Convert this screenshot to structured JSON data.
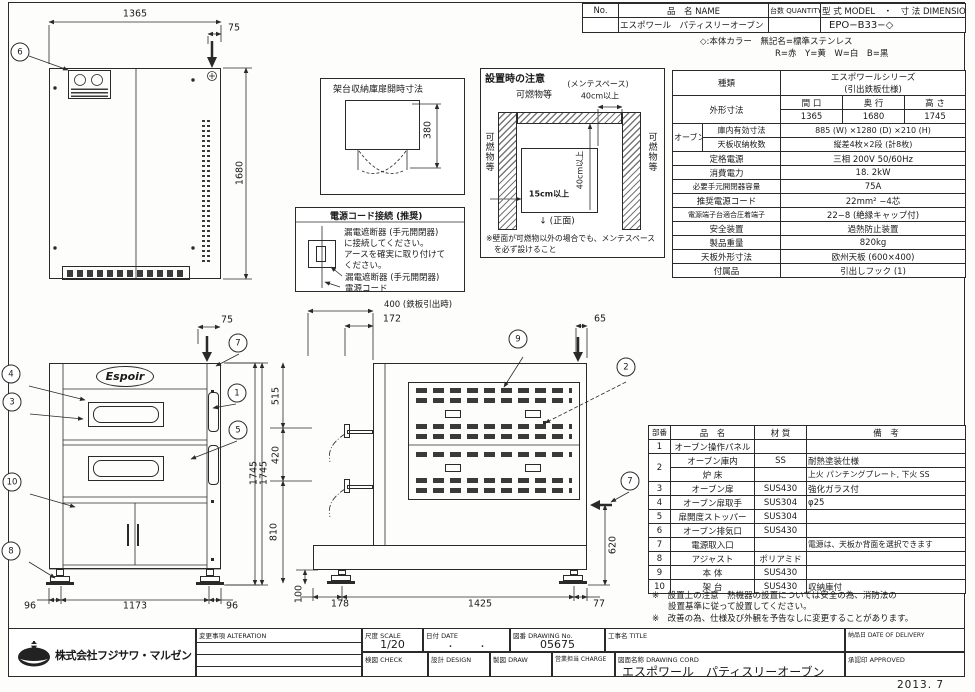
{
  "header_table": {
    "no_label": "No.",
    "name_label": "品　名 NAME",
    "qty_label": "台数 QUANTITY",
    "model_label": "型 式 MODEL　・　寸 法 DIMENSION",
    "name_value": "エスポワール　パティスリーオーブン",
    "model_value": "EPO−B33−◇",
    "color_note1": "◇:本体カラー　無記名=標準ステンレス",
    "color_note2": "R=赤　Y=黄　W=白　B=黒"
  },
  "spec": {
    "kind_label": "種類",
    "kind_value1": "エスポワールシリーズ",
    "kind_value2": "(引出鉄板仕様)",
    "outer_label": "外形寸法",
    "w_label": "間 口",
    "d_label": "奥 行",
    "h_label": "高 さ",
    "w_value": "1365",
    "d_value": "1680",
    "h_value": "1745",
    "oven_label": "オーブン",
    "inner_label": "庫内有効寸法",
    "inner_value": "885 (W) ×1280 (D) ×210 (H)",
    "tray_label": "天板収納枚数",
    "tray_value": "縦差4枚×2段 (計8枚)",
    "rows": [
      {
        "label": "定格電源",
        "value": "三相 200V 50/60Hz"
      },
      {
        "label": "消費電力",
        "value": "18. 2kW"
      },
      {
        "label": "必要手元開閉器容量",
        "value": "75A"
      },
      {
        "label": "推奨電源コード",
        "value": "22mm² −4芯"
      },
      {
        "label": "電源端子台適合圧着端子",
        "value": "22−8 (絶縁キャップ付)"
      },
      {
        "label": "安全装置",
        "value": "過熱防止装置"
      },
      {
        "label": "製品重量",
        "value": "820kg"
      },
      {
        "label": "天板外形寸法",
        "value": "欧州天板 (600×400)"
      },
      {
        "label": "付属品",
        "value": "引出しフック (1)"
      }
    ]
  },
  "parts": {
    "h_no": "部番",
    "h_name": "品　名",
    "h_mat": "材 質",
    "h_note": "備　考",
    "rows": [
      {
        "no": "1",
        "name": "オーブン操作パネル",
        "mat": "",
        "note": ""
      },
      {
        "no": "2",
        "name": "オーブン庫内",
        "mat": "SS",
        "note": "耐熱塗装仕様"
      },
      {
        "no": "",
        "name": "炉 床",
        "mat": "",
        "note": "上火 パンチングプレート, 下火 SS"
      },
      {
        "no": "3",
        "name": "オーブン扉",
        "mat": "SUS430",
        "note": "強化ガラス付"
      },
      {
        "no": "4",
        "name": "オーブン扉取手",
        "mat": "SUS304",
        "note": "φ25"
      },
      {
        "no": "5",
        "name": "扉開度ストッパー",
        "mat": "SUS304",
        "note": ""
      },
      {
        "no": "6",
        "name": "オーブン排気口",
        "mat": "SUS430",
        "note": ""
      },
      {
        "no": "7",
        "name": "電源取入口",
        "mat": "",
        "note": "電源は、天板か背面を選択できます"
      },
      {
        "no": "8",
        "name": "アジャスト",
        "mat": "ポリアミド",
        "note": ""
      },
      {
        "no": "9",
        "name": "本 体",
        "mat": "SUS430",
        "note": ""
      },
      {
        "no": "10",
        "name": "架 台",
        "mat": "SUS430",
        "note": "収納庫付"
      }
    ],
    "note1": "※　設置上の注意　熱機器の設置については安全の為、消防法の",
    "note2": "設置基準に従って設置してください。",
    "note3": "※　改善の為、仕様及び外観を予告なしに変更することがあります。"
  },
  "box1": {
    "title": "架台収納庫扉開時寸法",
    "dim380": "380"
  },
  "box2": {
    "title": "電源コード接続 (推奨)",
    "line1": "漏電遮断器 (手元開閉器)",
    "line2": "に接続してください。",
    "line3": "アースを確実に取り付けて",
    "line4": "ください。",
    "label1": "漏電遮断器 (手元開閉器)",
    "label2": "電源コード"
  },
  "box3": {
    "title": "設置時の注意",
    "flammable": "可燃物等",
    "maintenance": "(メンテスペース)",
    "d40_top": "40cm以上",
    "d40_side": "40cm以上",
    "d15": "15cm以上",
    "front_mark": "↓ (正面)",
    "note1": "※壁面が可燃物以外の場合でも、メンテスペース",
    "note2": "を必ず設けること"
  },
  "views": {
    "logo_text": "Espoir",
    "dims": {
      "plan_w": "1365",
      "plan_off": "75",
      "plan_d": "1680",
      "front_off": "75",
      "front_h": "1745",
      "front_b1": "96",
      "front_b2": "1173",
      "front_b3": "96",
      "side_pull": "400 (鉄板引出時)",
      "side_handle": "172",
      "side_off": "65",
      "side_515": "515",
      "side_420": "420",
      "side_810": "810",
      "side_100": "100",
      "side_620": "620",
      "side_b1": "178",
      "side_b2": "1425",
      "side_b3": "77"
    },
    "balloons": {
      "n1": "1",
      "n2": "2",
      "n3": "3",
      "n4": "4",
      "n5": "5",
      "n6": "6",
      "n7": "7",
      "n8": "8",
      "n9": "9",
      "n10": "10"
    }
  },
  "titleblock": {
    "company": "株式会社フジサワ・マルゼン",
    "alteration": "変更事項  ALTERATION",
    "scale_label": "尺度  SCALE",
    "scale_value": "1/20",
    "date_label": "日付  DATE",
    "date_value": "・　　　・",
    "dwg_label": "図番  DRAWING No.",
    "dwg_value": "05675",
    "title_label": "工事名  TITLE",
    "delivery_label": "納品日  DATE OF DELIVERY",
    "check_label": "検図  CHECK",
    "design_label": "設計  DESIGN",
    "draw_label": "製図  DRAW",
    "charge_label": "営業担当  CHARGE",
    "dwgname_label": "図面名称  DRAWING CORD",
    "dwgname_value": "エスポワール　パティスリーオーブン",
    "approved_label": "承認印  APPROVED",
    "date_stamp": "2013. 7"
  }
}
